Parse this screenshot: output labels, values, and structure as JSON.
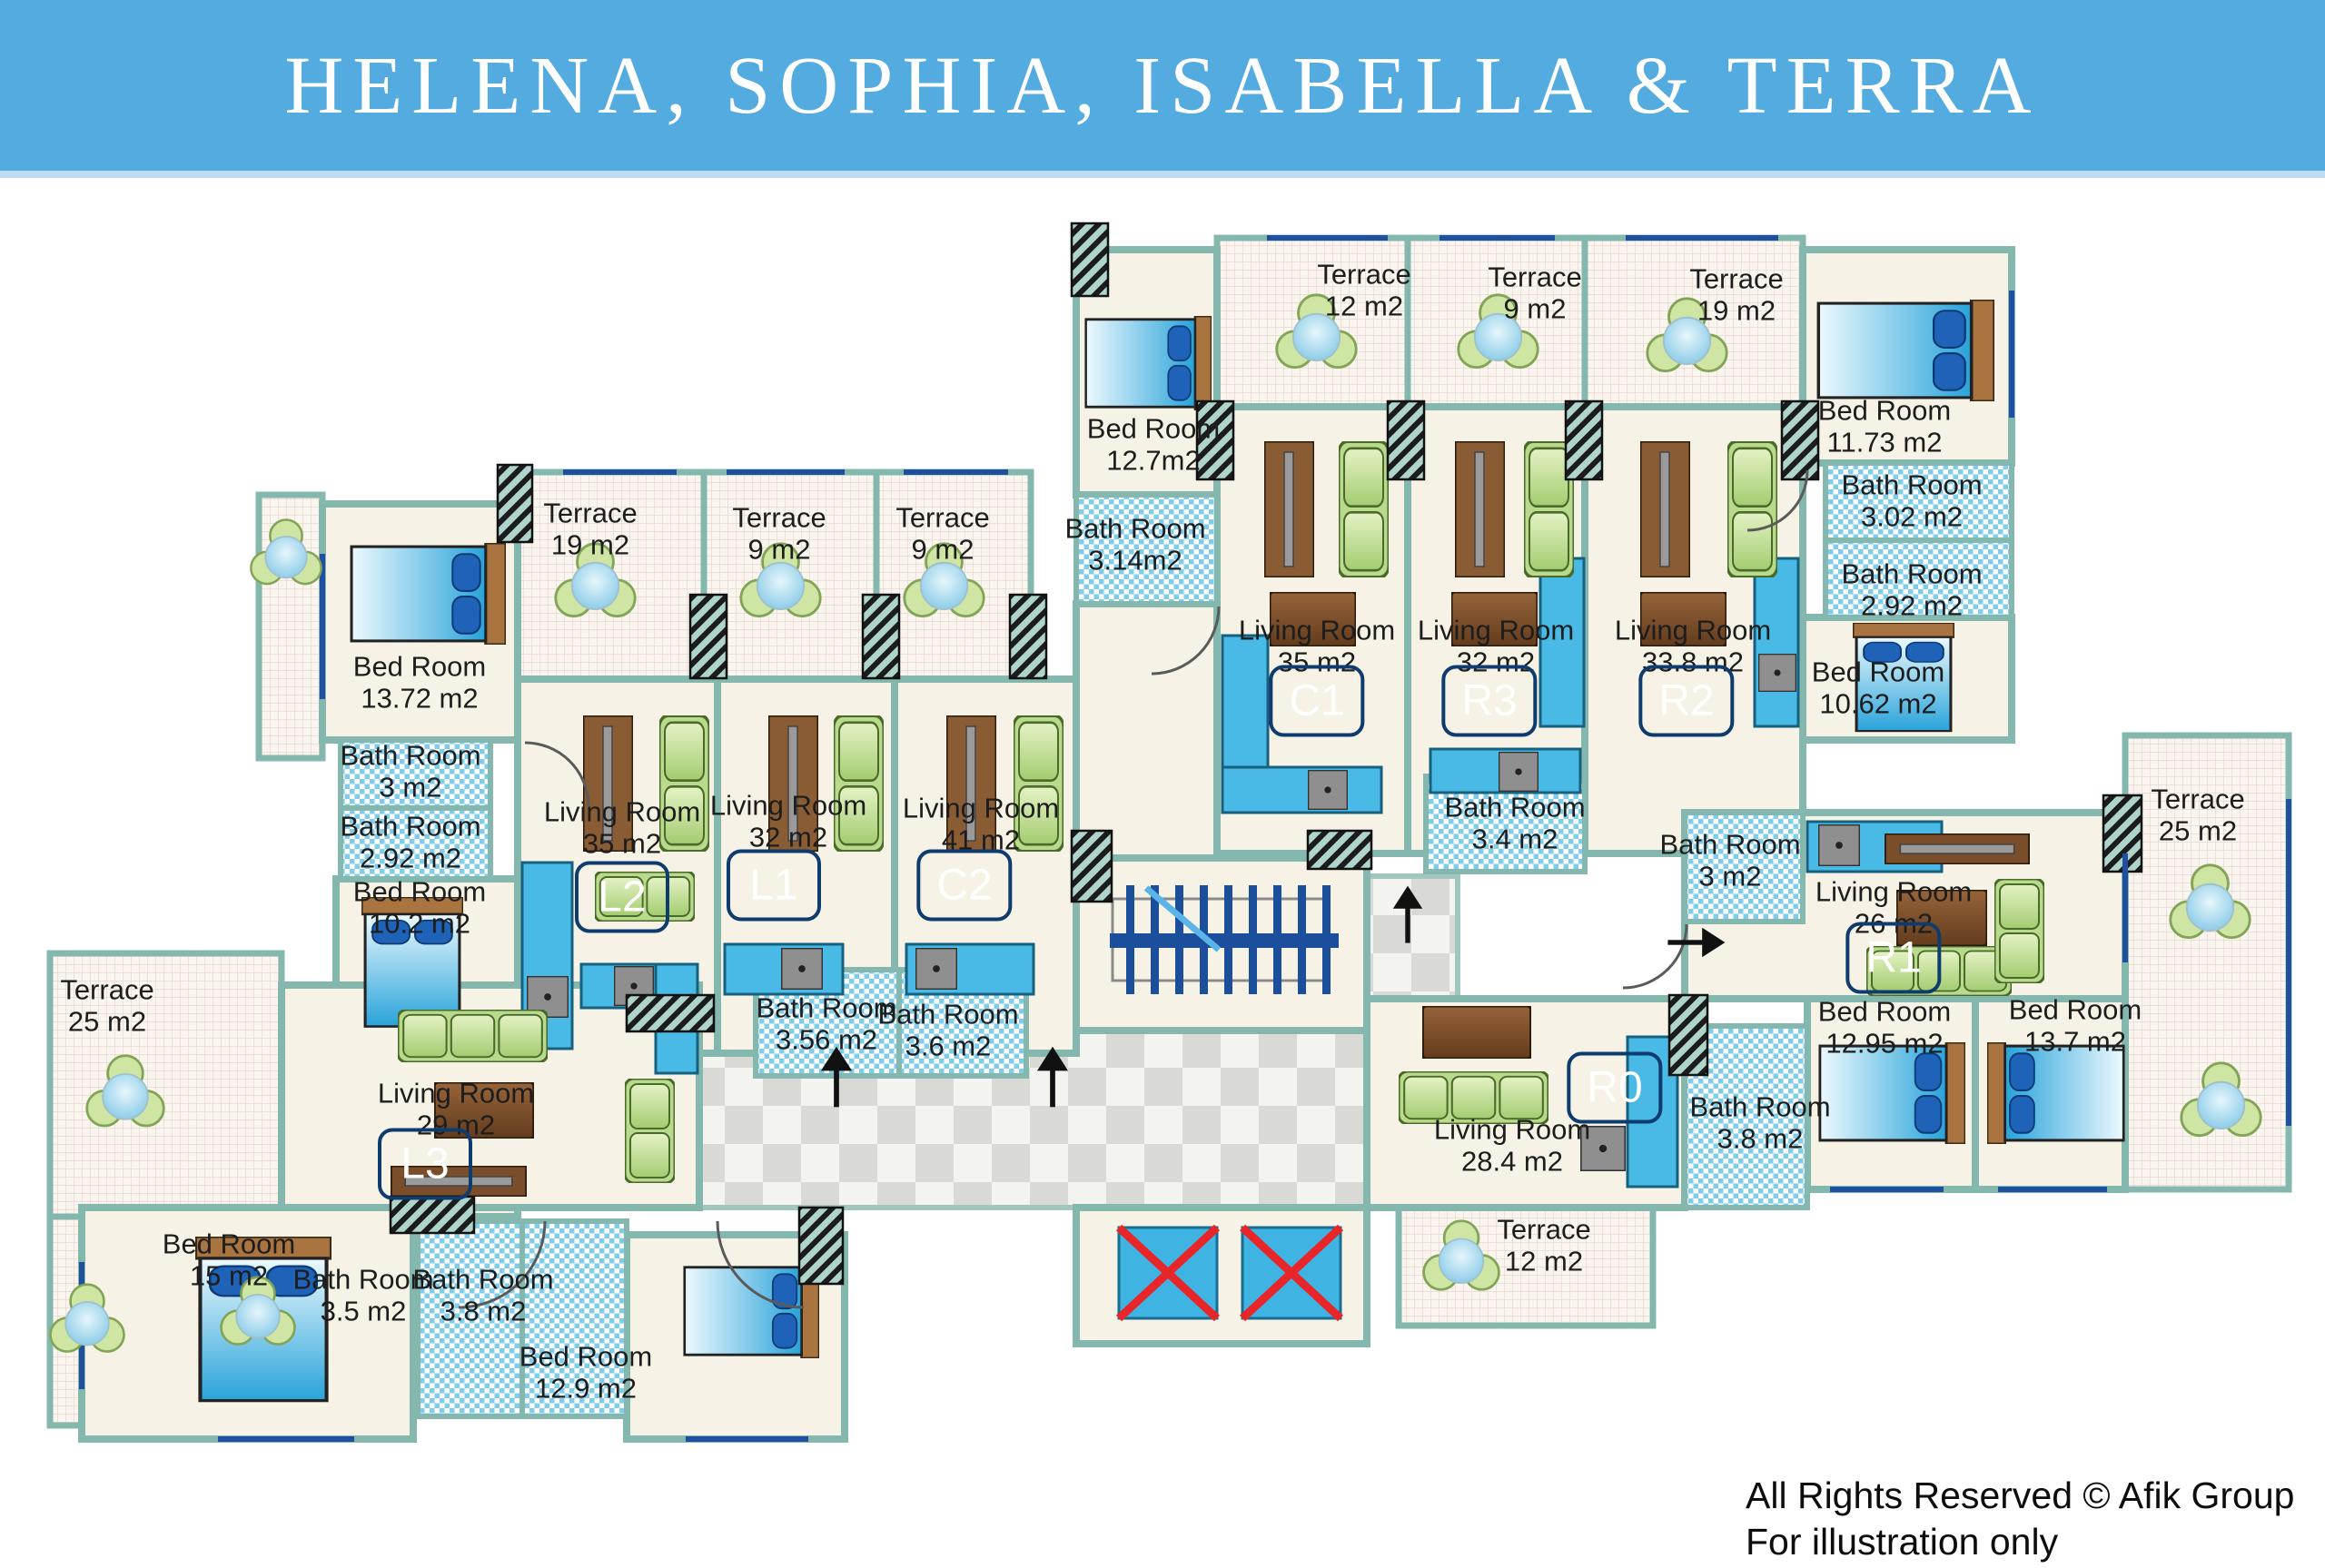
{
  "header": {
    "title": "HELENA, SOPHIA, ISABELLA & TERRA"
  },
  "footer": {
    "rights": "All Rights Reserved © Afik Group",
    "note": "For illustration only"
  },
  "colors": {
    "header_blue": "#54abe0",
    "wall_teal": "#84b8af",
    "floor_cream": "#f6f3e6",
    "bath_tile_blue": "#7fcde9",
    "terrace_grid_pink": "#e9d8d0",
    "corridor_gray": "#d9d9d6",
    "window_blue": "#1f4f9f",
    "unit_chip_blue": "#1b5ea6",
    "elevator_blue": "#3fb3e2",
    "elevator_x_red": "#e8262a",
    "sofa_green": "#b9d98c",
    "wood_brown": "#8a5c33",
    "bed_blue": "#29a3da"
  },
  "unit_labels": [
    "L2",
    "L1",
    "C2",
    "C1",
    "R3",
    "R2",
    "R1",
    "R0",
    "L3"
  ],
  "rooms": [
    {
      "name": "Terrace",
      "area": "19 m2"
    },
    {
      "name": "Terrace",
      "area": "9 m2"
    },
    {
      "name": "Terrace",
      "area": "9 m2"
    },
    {
      "name": "Bed Room",
      "area": "13.72 m2"
    },
    {
      "name": "Bath Room",
      "area": "3 m2"
    },
    {
      "name": "Bath Room",
      "area": "2.92 m2"
    },
    {
      "name": "Bed Room",
      "area": "10.2 m2"
    },
    {
      "name": "Living Room",
      "area": "35 m2"
    },
    {
      "name": "Living Room",
      "area": "32 m2"
    },
    {
      "name": "Living Room",
      "area": "41 m2"
    },
    {
      "name": "Bath Room",
      "area": "3.56 m2"
    },
    {
      "name": "Bath Room",
      "area": "3.6 m2"
    },
    {
      "name": "Terrace",
      "area": "12 m2"
    },
    {
      "name": "Terrace",
      "area": "9 m2"
    },
    {
      "name": "Terrace",
      "area": "19 m2"
    },
    {
      "name": "Bed Room",
      "area": "12.7m2"
    },
    {
      "name": "Bath Room",
      "area": "3.14m2"
    },
    {
      "name": "Living Room",
      "area": "35 m2"
    },
    {
      "name": "Living Room",
      "area": "32 m2"
    },
    {
      "name": "Living Room",
      "area": "33.8 m2"
    },
    {
      "name": "Bed Room",
      "area": "11.73 m2"
    },
    {
      "name": "Bath Room",
      "area": "3.02 m2"
    },
    {
      "name": "Bath Room",
      "area": "2.92 m2"
    },
    {
      "name": "Bed Room",
      "area": "10.62 m2"
    },
    {
      "name": "Bath Room",
      "area": "3.4 m2"
    },
    {
      "name": "Bath Room",
      "area": "3 m2"
    },
    {
      "name": "Living Room",
      "area": "26 m2"
    },
    {
      "name": "Terrace",
      "area": "25 m2"
    },
    {
      "name": "Living Room",
      "area": "28.4 m2"
    },
    {
      "name": "Bath Room",
      "area": "3.8 m2"
    },
    {
      "name": "Bed Room",
      "area": "12.95 m2"
    },
    {
      "name": "Bed Room",
      "area": "13.7 m2"
    },
    {
      "name": "Terrace",
      "area": "12 m2"
    },
    {
      "name": "Terrace",
      "area": "25 m2"
    },
    {
      "name": "Living Room",
      "area": "29 m2"
    },
    {
      "name": "Bed Room",
      "area": "15 m2"
    },
    {
      "name": "Bath Room",
      "area": "3.5 m2"
    },
    {
      "name": "Bath Room",
      "area": "3.8 m2"
    },
    {
      "name": "Bed Room",
      "area": "12.9 m2"
    }
  ]
}
